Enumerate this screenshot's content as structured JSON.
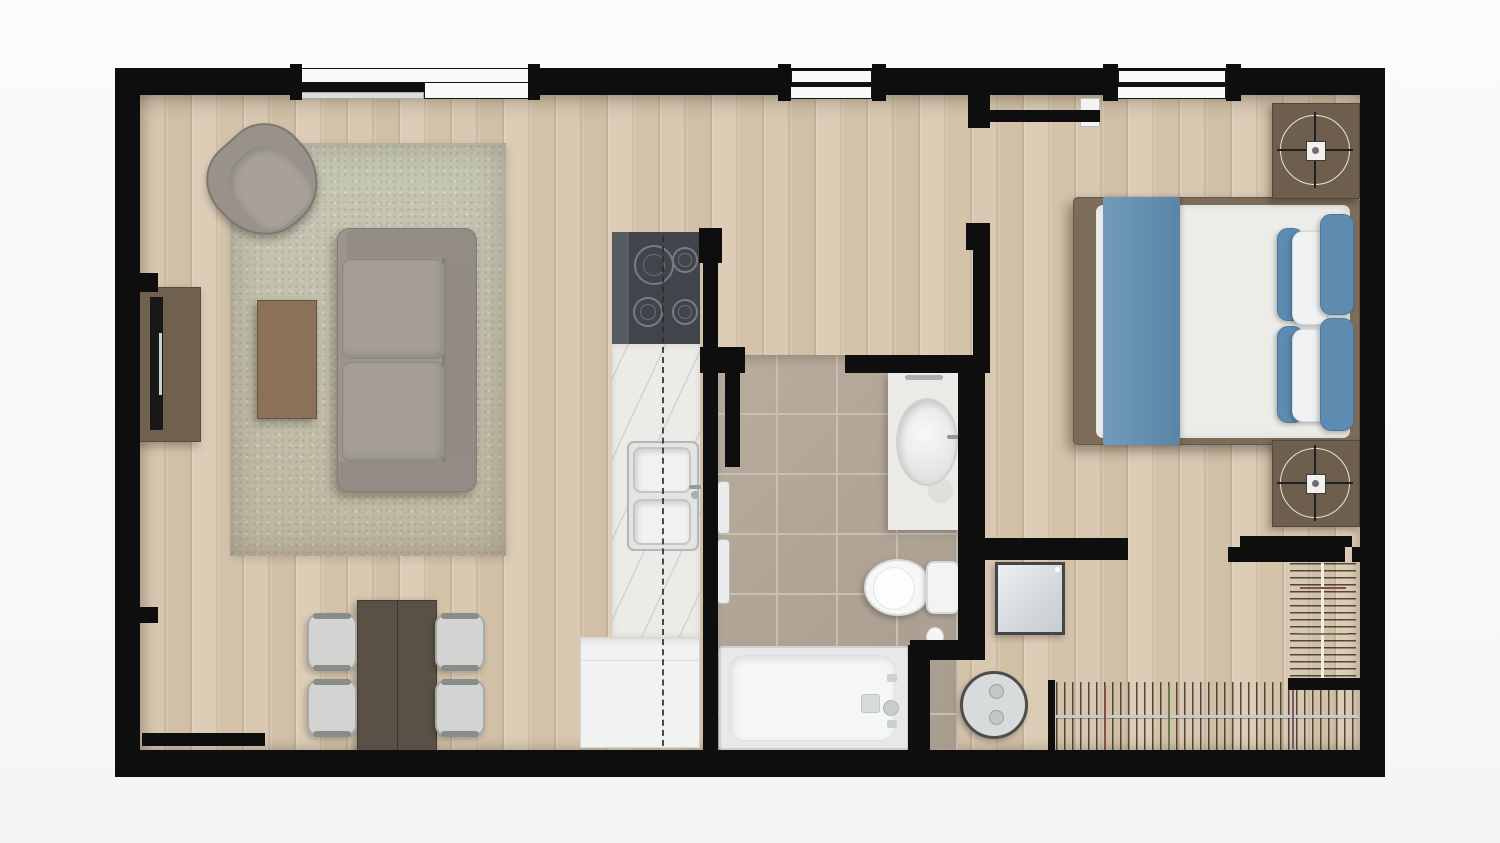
{
  "scene": {
    "type": "apartment-floor-plan",
    "view": "top-down-3d-render",
    "text_on_image": "none"
  },
  "palette": {
    "wall": "#0e0e0e",
    "wood_floor": "#d7c6af",
    "tile_floor": "#b4a899",
    "rug": "#c7c5b6",
    "upholstery_gray": "#9a948c",
    "dining_wood_dark": "#5a5045",
    "coffee_table_wood": "#8b7157",
    "nightstand_walnut": "#6d5e4d",
    "bedding_blue": "#6290b4",
    "linen_white": "#ecece9",
    "fixture_white": "#f4f5f5",
    "counter_marble": "#edebe7",
    "cooktop_black": "#41454b",
    "appliance_steel": "#dfe3e6"
  },
  "labels": {
    "floor_plan": "Apartment floor plan",
    "living_room": "Living room",
    "dining_area": "Dining area",
    "kitchen": "Kitchen",
    "bathroom": "Bathroom",
    "bedroom": "Bedroom",
    "closet": "Closet",
    "laundry_nook": "Laundry nook",
    "sofa": "Sofa",
    "armchair": "Armchair",
    "coffee_table": "Coffee table",
    "area_rug": "Area rug",
    "tv_console": "TV console",
    "tv": "Television",
    "dining_table": "Dining table",
    "dining_chair": "Dining chair",
    "cooktop": "Cooktop (4 burners)",
    "counter": "Kitchen counter",
    "double_sink": "Double sink",
    "base_cabinet": "Base cabinet",
    "vanity": "Vanity with sink",
    "toilet": "Toilet",
    "bathtub": "Bathtub",
    "towel_bar": "Towel bar",
    "bed": "Double bed",
    "nightstand": "Nightstand with lamp",
    "washer": "Washer",
    "round_table": "Round side table",
    "hanging_clothes": "Hanging clothes rod",
    "window": "Window",
    "door": "Door",
    "sliding_door": "Sliding door",
    "overhead_line": "Overhead cabinet dashed line"
  },
  "architecture": {
    "window_count": 3,
    "windows": [
      {
        "wall": "top",
        "over": "living-room"
      },
      {
        "wall": "top",
        "over": "hallway"
      },
      {
        "wall": "top",
        "over": "bedroom"
      }
    ],
    "doors": [
      {
        "type": "swing",
        "location": "entry-hallway-top"
      },
      {
        "type": "swing",
        "location": "bathroom"
      },
      {
        "type": "sliding",
        "location": "bedroom-to-closet"
      },
      {
        "type": "swing",
        "location": "bottom-left"
      }
    ]
  },
  "rooms": [
    {
      "name": "living-room",
      "furniture": [
        "tv-console",
        "tv",
        "armchair",
        "sofa",
        "coffee-table",
        "area-rug"
      ]
    },
    {
      "name": "dining-area",
      "furniture": [
        "dining-table",
        "dining-chair x4"
      ]
    },
    {
      "name": "kitchen",
      "furniture": [
        "cooktop",
        "counter",
        "double-sink",
        "base-cabinet"
      ]
    },
    {
      "name": "bathroom",
      "furniture": [
        "vanity-sink",
        "toilet",
        "toilet-paper-holder",
        "bathtub",
        "towel-bar x2"
      ]
    },
    {
      "name": "bedroom",
      "furniture": [
        "double-bed",
        "blue-blanket",
        "pillows x6",
        "nightstand x2",
        "table-lamp x2"
      ]
    },
    {
      "name": "closet",
      "furniture": [
        "hanging-rod-vertical",
        "hanging-rod-horizontal"
      ]
    },
    {
      "name": "laundry-nook",
      "furniture": [
        "washer",
        "round-side-table"
      ]
    }
  ]
}
